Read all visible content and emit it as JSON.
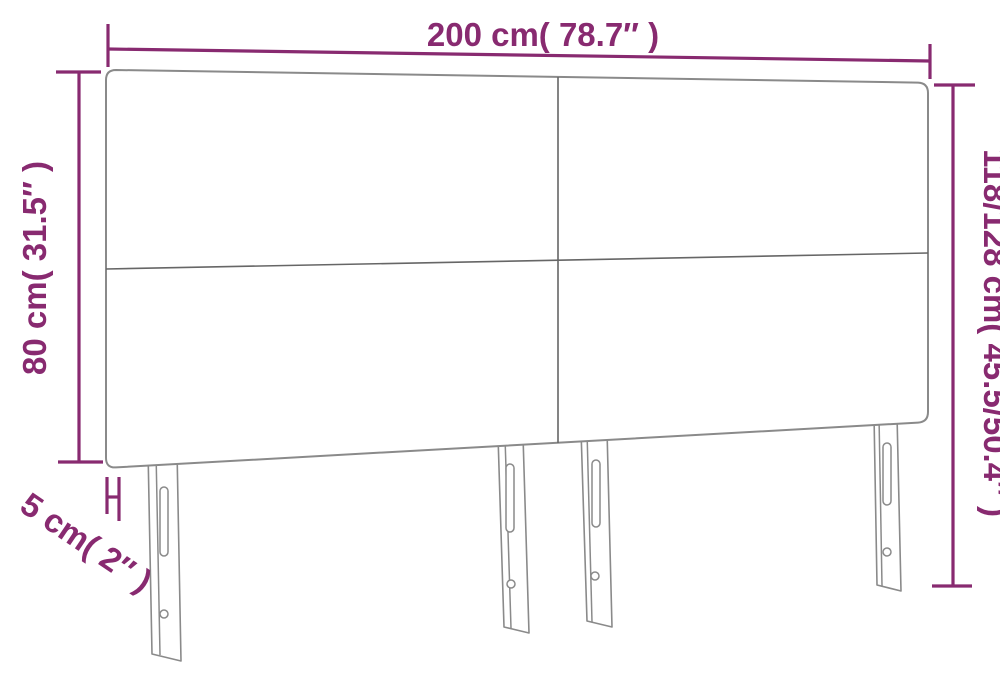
{
  "diagram": {
    "name": "headboard-dimension-diagram",
    "subject": "upholstered headboard with 4 panels and 4 slotted legs",
    "colors": {
      "dimension": "#882a70",
      "outline": "#8a8a8a",
      "divider": "#666666",
      "leg": "#8a8a8a"
    },
    "dimensions": {
      "width": {
        "label": "200 cm( 78.7″ )"
      },
      "panel_height": {
        "label": "80 cm( 31.5″ )"
      },
      "total_height": {
        "label": "118/128 cm( 45.5/50.4″ )"
      },
      "thickness": {
        "label": "5 cm( 2″ )"
      }
    }
  }
}
